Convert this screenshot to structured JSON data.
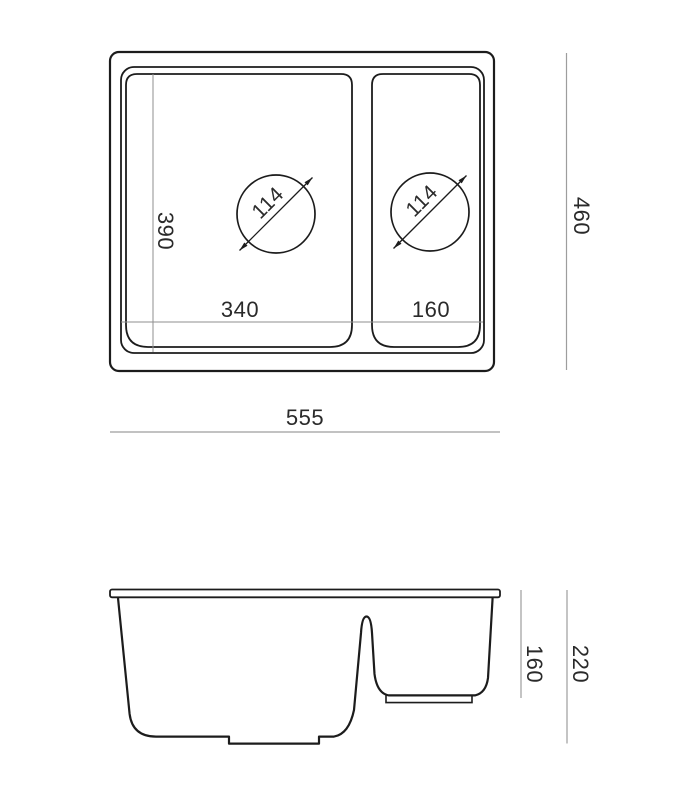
{
  "drawing": {
    "type": "sink-technical-drawing",
    "views": [
      "top-view",
      "front-view"
    ],
    "colors": {
      "outline": "#1c1c1c",
      "dimension_line": "#9d9d9d",
      "label_text": "#2a2a2a",
      "background": "#ffffff"
    }
  },
  "labels": {
    "overall_width": "555",
    "overall_depth": "460",
    "main_bowl_width": "340",
    "main_bowl_depth": "390",
    "second_bowl_width": "160",
    "main_drain_diameter": "114",
    "second_drain_diameter": "114",
    "second_bowl_height": "160",
    "overall_height": "220"
  }
}
